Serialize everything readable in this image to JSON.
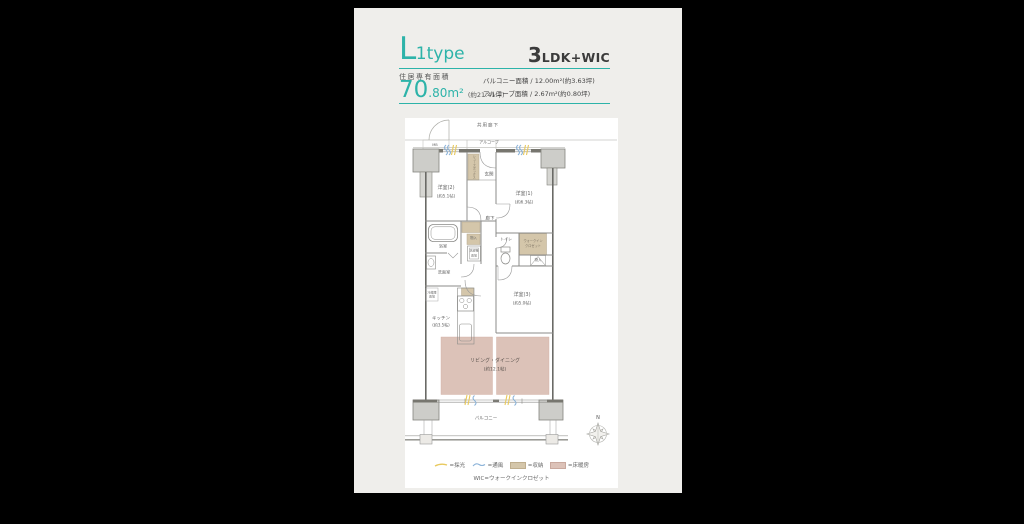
{
  "colors": {
    "background": "#000000",
    "panel": "#efeeeb",
    "accent": "#2db3a9",
    "storage": "#d4c6aa",
    "floor_heating": "#dcc2b8",
    "daylight": "#e8c95e",
    "wind": "#8ab2d8"
  },
  "header": {
    "type_big": "L",
    "type_small": "1type",
    "layout_big": "3",
    "layout_small": "LDK+WIC",
    "area_label": "住居専有面積",
    "area_int": "70",
    "area_frac": ".80m²",
    "area_tsubo": "(約21.41坪)",
    "balcony_area": "バルコニー面積 / 12.00m²(約3.63坪)",
    "alcove_area": "アルコーブ面積 / 2.67m²(約0.80坪)"
  },
  "plan": {
    "corridor": "共用廊下",
    "alcove": "アルコーブ",
    "mb": "MB",
    "entrance": "玄関",
    "shoebox": "シューズボックス",
    "room2": "洋室(2)",
    "room2_size": "(約5.1帖)",
    "room1": "洋室(1)",
    "room1_size": "(約6.3帖)",
    "room3": "洋室(3)",
    "room3_size": "(約5.0帖)",
    "hall": "廊下",
    "bath": "浴室",
    "storage_a": "物入",
    "laundry_1": "洗濯機",
    "laundry_2": "置場",
    "toilet": "トイレ",
    "wic_1": "ウォークイン",
    "wic_2": "クロゼット",
    "storage_b": "物入",
    "washroom": "洗面室",
    "fridge_1": "冷蔵庫",
    "fridge_2": "置場",
    "kitchen": "キッチン",
    "kitchen_size": "(約3.5帖)",
    "living": "リビング・ダイニング",
    "living_size": "(約12.1帖)",
    "balcony": "バルコニー",
    "compass_north": "N"
  },
  "legend": {
    "items": [
      {
        "label": "=採光"
      },
      {
        "label": "=通風"
      },
      {
        "label": "=収納"
      },
      {
        "label": "=床暖房"
      }
    ],
    "wic_note": "WIC=ウォークインクロゼット"
  }
}
